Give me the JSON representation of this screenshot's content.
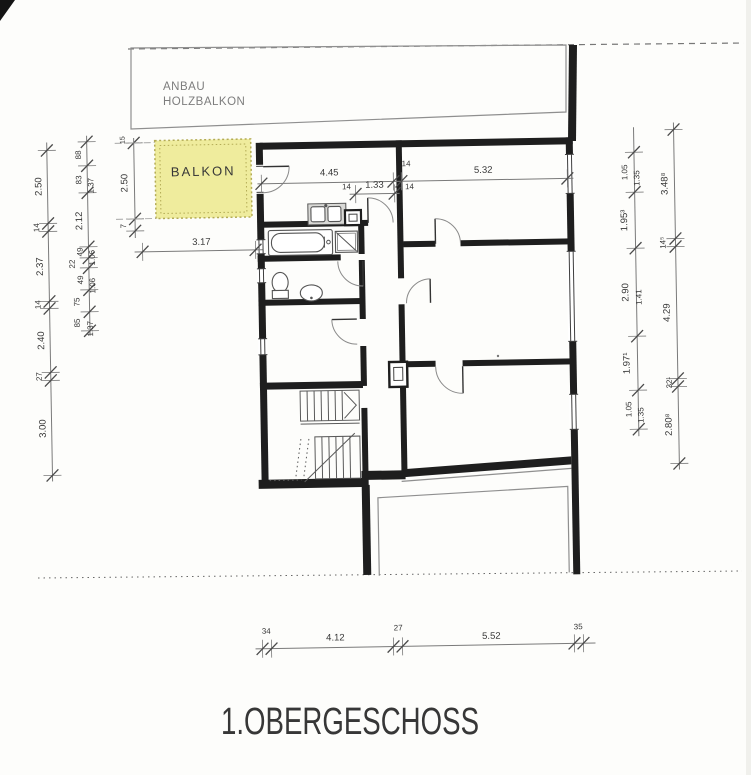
{
  "labels": {
    "title": "1.OBERGESCHOSS",
    "anbau_line1": "ANBAU",
    "anbau_line2": "HOLZBALKON",
    "balkon": "BALKON"
  },
  "dims": {
    "top_main": [
      "4.45",
      "14",
      "5.32"
    ],
    "top_inner": [
      "14",
      "1.33",
      "14"
    ],
    "balcony": {
      "height": "2.50",
      "width": "3.17",
      "wall_top": "15",
      "wall_bottom": "7"
    },
    "left_outer": [
      "2.50",
      "14",
      "2.37",
      "14",
      "2.40",
      "27",
      "3.00"
    ],
    "left_inner": [
      "88",
      "83",
      "1.37",
      "2.12",
      "49",
      "1.06",
      "22",
      "49",
      "1.06",
      "75",
      "85",
      "1.37"
    ],
    "right_inner": [
      "1.05",
      "1.35",
      "1.95³",
      "2.90",
      "1.41",
      "1.97¹",
      "1.05",
      "1.35"
    ],
    "right_outer": [
      "3.48⁸",
      "14⁵",
      "4.29",
      "32¹",
      "2.80⁸"
    ],
    "bottom": [
      "34",
      "4.12",
      "27",
      "5.52",
      "35"
    ]
  },
  "colors": {
    "balcony_fill": "#efec9d",
    "balcony_border": "#b3ab55",
    "wall": "#1e1e1e",
    "thin_outline": "#8f8f8f",
    "paper": "#fdfdfb"
  }
}
